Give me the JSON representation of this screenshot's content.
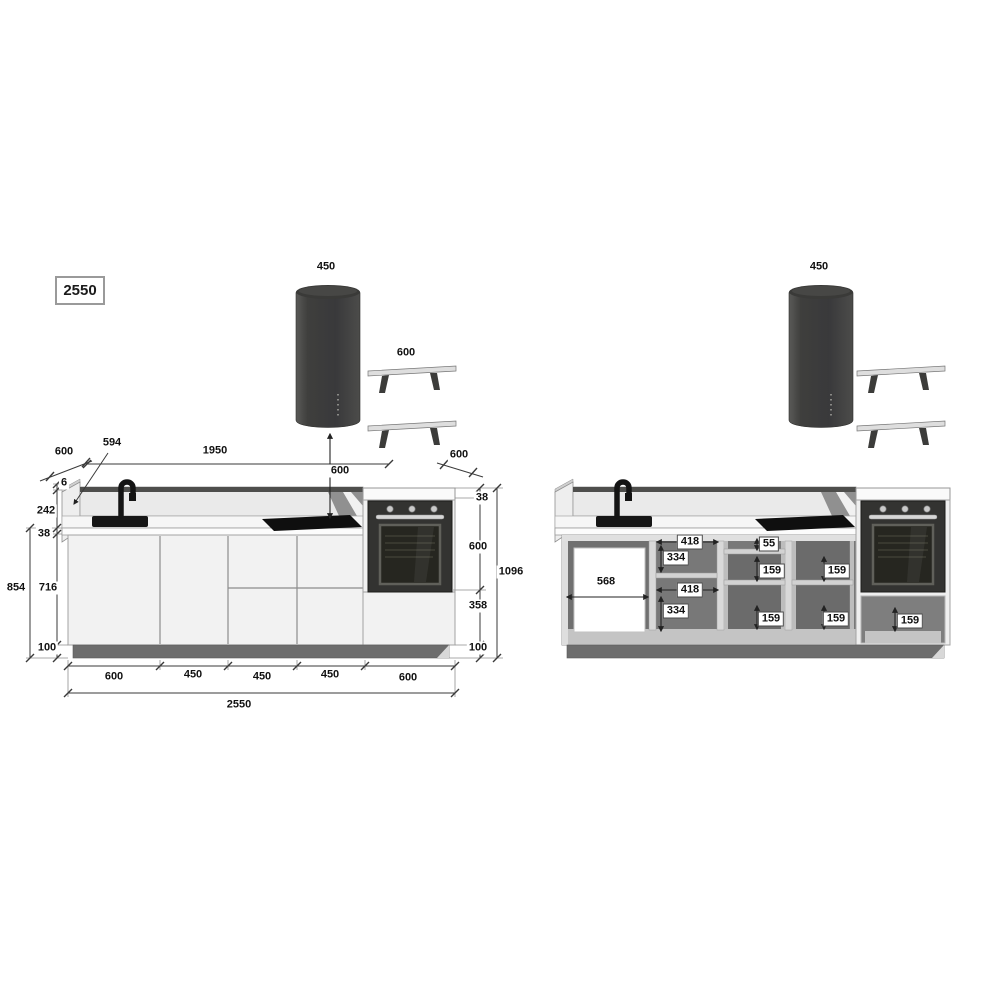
{
  "title_box": "2550",
  "left_view": {
    "hood_width": "450",
    "shelves_width": "600",
    "hood_clearance": "600",
    "depth_left": "600",
    "side_panel_length": "594",
    "wall_span": "1950",
    "depth_right": "600",
    "panel_thickness": "6",
    "backsplash_height": "242",
    "countertop_thickness": "38",
    "base_unit_height": "716",
    "worktop_height": "854",
    "plinth_height": "100",
    "tall_countertop_thickness": "38",
    "oven_height": "600",
    "below_oven_height": "358",
    "tall_plinth_height": "100",
    "tall_unit_height": "1096",
    "bottom_widths": [
      "600",
      "450",
      "450",
      "450",
      "600"
    ],
    "total_width": "2550"
  },
  "right_view": {
    "hood_width": "450",
    "appliance_gap_width": "568",
    "shelf_unit": {
      "top_width": "418",
      "top_height": "334",
      "bottom_width": "418",
      "bottom_height": "334"
    },
    "drawer_unit_a": {
      "top_drawer": "55",
      "middle_drawer": "159",
      "bottom_drawer": "159"
    },
    "drawer_unit_b": {
      "top_drawer": "159",
      "bottom_drawer": "159"
    },
    "oven_unit_drawer": "159"
  }
}
